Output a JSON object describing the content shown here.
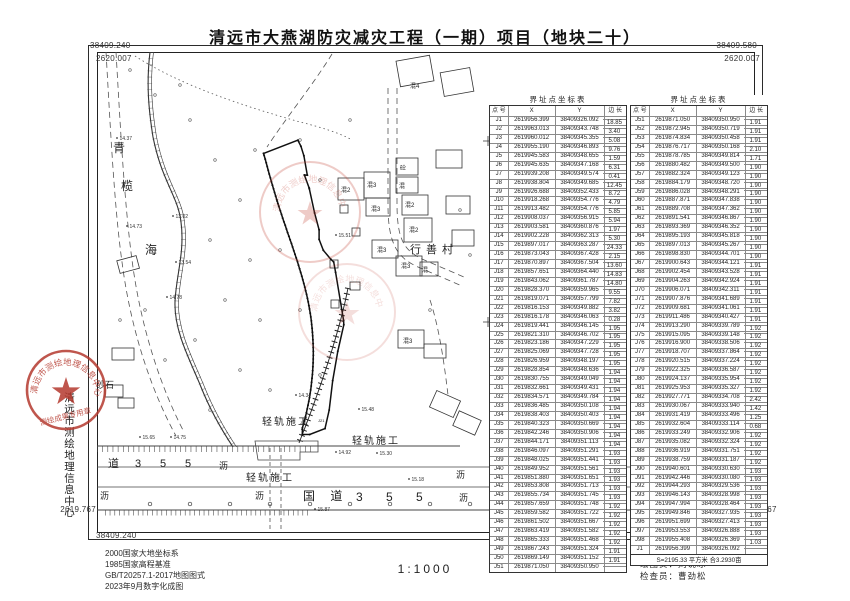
{
  "title": "清远市大燕湖防灾减灾工程（一期）项目（地块二十）",
  "frame": {
    "top_left_x": "38409.240",
    "top_left_y": "2620.007",
    "top_right_x": "38409.580",
    "top_right_y": "2620.007",
    "bottom_left_y": "2619.767",
    "bottom_left_x": "38409.240",
    "bottom_right_y": "2619.767",
    "bottom_right_x": "38409.580"
  },
  "tables": [
    {
      "title": "界址点坐标表",
      "headers": [
        "点 号",
        "X",
        "Y",
        "边 长"
      ],
      "rows": [
        [
          "J1",
          "2619956.399",
          "38409326.092"
        ],
        [
          "J2",
          "2619963.013",
          "38409343.748"
        ],
        [
          "J3",
          "2619960.012",
          "38409345.355"
        ],
        [
          "J4",
          "2619955.190",
          "38409346.893"
        ],
        [
          "J5",
          "2619945.583",
          "38409348.655"
        ],
        [
          "J6",
          "2619945.635",
          "38409347.168"
        ],
        [
          "J7",
          "2619939.208",
          "38409349.574"
        ],
        [
          "J8",
          "2619938.804",
          "38409349.685"
        ],
        [
          "J9",
          "2619926.688",
          "38409352.433"
        ],
        [
          "J10",
          "2619918.268",
          "38409354.776"
        ],
        [
          "J11",
          "2619913.482",
          "38409354.776"
        ],
        [
          "J12",
          "2619908.037",
          "38409356.915"
        ],
        [
          "J13",
          "2619903.581",
          "38409360.876"
        ],
        [
          "J14",
          "2619902.228",
          "38409362.313"
        ],
        [
          "J15",
          "2619897.017",
          "38409363.287"
        ],
        [
          "J16",
          "2619873.043",
          "38409367.428"
        ],
        [
          "J17",
          "2619870.897",
          "38409367.504"
        ],
        [
          "J18",
          "2619857.651",
          "38409364.440"
        ],
        [
          "J19",
          "2619843.062",
          "38409361.787"
        ],
        [
          "J20",
          "2619828.370",
          "38409359.965"
        ],
        [
          "J21",
          "2619819.071",
          "38409357.799"
        ],
        [
          "J22",
          "2619816.153",
          "38409349.882"
        ],
        [
          "J23",
          "2619816.178",
          "38409346.063"
        ],
        [
          "J24",
          "2619819.441",
          "38409346.145"
        ],
        [
          "J25",
          "2619821.310",
          "38409346.702"
        ],
        [
          "J26",
          "2619823.186",
          "38409347.229"
        ],
        [
          "J27",
          "2619825.069",
          "38409347.728"
        ],
        [
          "J28",
          "2619826.959",
          "38409348.197"
        ],
        [
          "J29",
          "2619828.854",
          "38409348.636"
        ],
        [
          "J30",
          "2619830.755",
          "38409349.049"
        ],
        [
          "J31",
          "2619832.661",
          "38409349.431"
        ],
        [
          "J32",
          "2619834.571",
          "38409349.784"
        ],
        [
          "J33",
          "2619836.485",
          "38409350.108"
        ],
        [
          "J34",
          "2619838.403",
          "38409350.403"
        ],
        [
          "J35",
          "2619840.323",
          "38409350.669"
        ],
        [
          "J36",
          "2619842.246",
          "38409350.906"
        ],
        [
          "J37",
          "2619844.171",
          "38409351.113"
        ],
        [
          "J38",
          "2619846.097",
          "38409351.291"
        ],
        [
          "J39",
          "2619848.025",
          "38409351.441"
        ],
        [
          "J40",
          "2619849.952",
          "38409351.561"
        ],
        [
          "J41",
          "2619851.880",
          "38409351.651"
        ],
        [
          "J42",
          "2619853.808",
          "38409351.713"
        ],
        [
          "J43",
          "2619855.734",
          "38409351.745"
        ],
        [
          "J44",
          "2619857.659",
          "38409351.748"
        ],
        [
          "J45",
          "2619859.582",
          "38409351.722"
        ],
        [
          "J46",
          "2619861.502",
          "38409351.667"
        ],
        [
          "J47",
          "2619863.419",
          "38409351.582"
        ],
        [
          "J48",
          "2619865.333",
          "38409351.468"
        ],
        [
          "J49",
          "2619867.243",
          "38409351.324"
        ],
        [
          "J50",
          "2619869.149",
          "38409351.152"
        ],
        [
          "J51",
          "2619871.050",
          "38409350.950"
        ]
      ],
      "edge_lengths": [
        "18.85",
        "3.40",
        "5.08",
        "9.76",
        "1.59",
        "6.31",
        "0.41",
        "12.45",
        "8.72",
        "4.79",
        "5.85",
        "5.94",
        "1.97",
        "5.30",
        "24.33",
        "2.15",
        "13.60",
        "14.83",
        "14.80",
        "9.55",
        "7.82",
        "3.82",
        "0.28",
        "1.95",
        "1.95",
        "1.95",
        "1.95",
        "1.95",
        "1.94",
        "1.94",
        "1.94",
        "1.94",
        "1.94",
        "1.94",
        "1.94",
        "1.94",
        "1.94",
        "1.93",
        "1.93",
        "1.93",
        "1.93",
        "1.93",
        "1.93",
        "1.92",
        "1.92",
        "1.92",
        "1.92",
        "1.92",
        "1.91",
        "1.91"
      ]
    },
    {
      "title": "界址点坐标表",
      "headers": [
        "点 号",
        "X",
        "Y",
        "边 长"
      ],
      "rows": [
        [
          "J51",
          "2619871.050",
          "38409350.950"
        ],
        [
          "J52",
          "2619872.945",
          "38409350.719"
        ],
        [
          "J53",
          "2619874.834",
          "38409350.458"
        ],
        [
          "J54",
          "2619876.717",
          "38409350.168"
        ],
        [
          "J55",
          "2619878.785",
          "38409349.814"
        ],
        [
          "J56",
          "2619880.482",
          "38409349.500"
        ],
        [
          "J57",
          "2619882.324",
          "38409349.123"
        ],
        [
          "J58",
          "2619884.179",
          "38409348.720"
        ],
        [
          "J59",
          "2619886.028",
          "38409348.291"
        ],
        [
          "J60",
          "2619887.871",
          "38409347.838"
        ],
        [
          "J61",
          "2619889.708",
          "38409347.362"
        ],
        [
          "J62",
          "2619891.541",
          "38409346.867"
        ],
        [
          "J63",
          "2619893.369",
          "38409346.352"
        ],
        [
          "J64",
          "2619895.193",
          "38409345.818"
        ],
        [
          "J65",
          "2619897.013",
          "38409345.267"
        ],
        [
          "J66",
          "2619898.830",
          "38409344.701"
        ],
        [
          "J67",
          "2619900.643",
          "38409344.121"
        ],
        [
          "J68",
          "2619902.454",
          "38409343.528"
        ],
        [
          "J69",
          "2619904.263",
          "38409342.924"
        ],
        [
          "J70",
          "2619906.071",
          "38409342.311"
        ],
        [
          "J71",
          "2619907.876",
          "38409341.689"
        ],
        [
          "J72",
          "2619909.681",
          "38409341.061"
        ],
        [
          "J73",
          "2619911.486",
          "38409340.427"
        ],
        [
          "J74",
          "2619913.290",
          "38409339.789"
        ],
        [
          "J75",
          "2619915.095",
          "38409339.148"
        ],
        [
          "J76",
          "2619916.900",
          "38409338.506"
        ],
        [
          "J77",
          "2619918.707",
          "38409337.864"
        ],
        [
          "J78",
          "2619920.515",
          "38409337.224"
        ],
        [
          "J79",
          "2619922.325",
          "38409336.587"
        ],
        [
          "J80",
          "2619924.137",
          "38409335.954"
        ],
        [
          "J81",
          "2619925.953",
          "38409335.327"
        ],
        [
          "J82",
          "2619927.771",
          "38409334.708"
        ],
        [
          "J83",
          "2619930.067",
          "38409333.940"
        ],
        [
          "J84",
          "2619931.419",
          "38409333.496"
        ],
        [
          "J85",
          "2619932.604",
          "38409333.114"
        ],
        [
          "J86",
          "2619933.249",
          "38409332.906"
        ],
        [
          "J87",
          "2619935.082",
          "38409332.324"
        ],
        [
          "J88",
          "2619936.919",
          "38409331.751"
        ],
        [
          "J89",
          "2619938.759",
          "38409331.187"
        ],
        [
          "J90",
          "2619940.601",
          "38409330.630"
        ],
        [
          "J91",
          "2619942.446",
          "38409330.080"
        ],
        [
          "J92",
          "2619944.293",
          "38409329.536"
        ],
        [
          "J93",
          "2619946.143",
          "38409328.998"
        ],
        [
          "J94",
          "2619947.994",
          "38409328.464"
        ],
        [
          "J95",
          "2619949.846",
          "38409327.935"
        ],
        [
          "J96",
          "2619951.699",
          "38409327.413"
        ],
        [
          "J97",
          "2619953.553",
          "38409326.888"
        ],
        [
          "J98",
          "2619955.408",
          "38409326.369"
        ],
        [
          "J1",
          "2619956.399",
          "38409326.092"
        ]
      ],
      "edge_lengths": [
        "1.91",
        "1.91",
        "1.91",
        "2.10",
        "1.71",
        "1.90",
        "1.90",
        "1.90",
        "1.90",
        "1.90",
        "1.90",
        "1.90",
        "1.90",
        "1.90",
        "1.90",
        "1.90",
        "1.91",
        "1.91",
        "1.91",
        "1.91",
        "1.91",
        "1.91",
        "1.91",
        "1.92",
        "1.92",
        "1.92",
        "1.92",
        "1.92",
        "1.92",
        "1.92",
        "1.92",
        "2.42",
        "1.42",
        "1.25",
        "0.68",
        "1.92",
        "1.92",
        "1.92",
        "1.92",
        "1.93",
        "1.93",
        "1.93",
        "1.93",
        "1.93",
        "1.93",
        "1.93",
        "1.93",
        "1.03"
      ],
      "footer": "S=2195.33  平方米  合3.2930亩"
    }
  ],
  "map": {
    "labels": [
      {
        "t": "青",
        "x": 113,
        "y": 152,
        "s": 12
      },
      {
        "t": "榄",
        "x": 121,
        "y": 190,
        "s": 12
      },
      {
        "t": "海",
        "x": 145,
        "y": 254,
        "s": 12
      },
      {
        "t": "砂石",
        "x": 38,
        "y": 308,
        "s": 9
      },
      {
        "t": "砂石",
        "x": 96,
        "y": 388,
        "s": 9
      },
      {
        "t": "轻轨施工",
        "x": 262,
        "y": 425,
        "s": 10,
        "ls": 2
      },
      {
        "t": "轻轨施工",
        "x": 352,
        "y": 444,
        "s": 10,
        "ls": 2
      },
      {
        "t": "轻轨施工",
        "x": 246,
        "y": 481,
        "s": 10,
        "ls": 2
      },
      {
        "t": "行善村",
        "x": 410,
        "y": 253,
        "s": 11,
        "ls": 5
      },
      {
        "t": "混2",
        "x": 341,
        "y": 192,
        "s": 6
      },
      {
        "t": "混3",
        "x": 367,
        "y": 187,
        "s": 6
      },
      {
        "t": "砼",
        "x": 400,
        "y": 170,
        "s": 6
      },
      {
        "t": "混",
        "x": 399,
        "y": 188,
        "s": 6
      },
      {
        "t": "混2",
        "x": 405,
        "y": 207,
        "s": 6
      },
      {
        "t": "混3",
        "x": 371,
        "y": 211,
        "s": 6
      },
      {
        "t": "混2",
        "x": 409,
        "y": 232,
        "s": 6
      },
      {
        "t": "混3",
        "x": 377,
        "y": 252,
        "s": 6
      },
      {
        "t": "混3",
        "x": 401,
        "y": 268,
        "s": 6
      },
      {
        "t": "混",
        "x": 422,
        "y": 272,
        "s": 6
      },
      {
        "t": "混4",
        "x": 410,
        "y": 88,
        "s": 6
      },
      {
        "t": "混3",
        "x": 403,
        "y": 343,
        "s": 6
      },
      {
        "t": "国  道",
        "x": 303,
        "y": 500,
        "s": 12,
        "ls": 6
      },
      {
        "t": "3  5  5",
        "x": 356,
        "y": 501,
        "s": 12,
        "ls": 10
      },
      {
        "t": "道",
        "x": 108,
        "y": 467,
        "s": 11
      },
      {
        "t": "3",
        "x": 135,
        "y": 467,
        "s": 11
      },
      {
        "t": "5",
        "x": 160,
        "y": 467,
        "s": 11
      },
      {
        "t": "5",
        "x": 185,
        "y": 467,
        "s": 11
      },
      {
        "t": "沥",
        "x": 219,
        "y": 469,
        "s": 9
      },
      {
        "t": "沥",
        "x": 100,
        "y": 499,
        "s": 9
      },
      {
        "t": "沥",
        "x": 255,
        "y": 499,
        "s": 9
      },
      {
        "t": "沥",
        "x": 456,
        "y": 478,
        "s": 9
      },
      {
        "t": "沥",
        "x": 459,
        "y": 501,
        "s": 9
      },
      {
        "t": "J22",
        "x": 300,
        "y": 424,
        "s": 4
      },
      {
        "t": "J21",
        "x": 318,
        "y": 422,
        "s": 4
      }
    ],
    "spot_elevations": [
      {
        "x": 117,
        "y": 138,
        "v": "14.37"
      },
      {
        "x": 127,
        "y": 226,
        "v": "14.73"
      },
      {
        "x": 173,
        "y": 216,
        "v": "13.02"
      },
      {
        "x": 176,
        "y": 262,
        "v": "13.54"
      },
      {
        "x": 167,
        "y": 297,
        "v": "14.78"
      },
      {
        "x": 140,
        "y": 437,
        "v": "15.65"
      },
      {
        "x": 171,
        "y": 437,
        "v": "14.75"
      },
      {
        "x": 336,
        "y": 235,
        "v": "15.51"
      },
      {
        "x": 296,
        "y": 395,
        "v": "14.34"
      },
      {
        "x": 336,
        "y": 452,
        "v": "14.92"
      },
      {
        "x": 359,
        "y": 409,
        "v": "15.48"
      },
      {
        "x": 377,
        "y": 453,
        "v": "15.30"
      },
      {
        "x": 409,
        "y": 479,
        "v": "15.18"
      },
      {
        "x": 315,
        "y": 509,
        "v": "15.87"
      }
    ]
  },
  "stamps": {
    "ring_text": "清远市测绘地理信息中心",
    "banner_text": "测绘成果专用章"
  },
  "footer": {
    "notes": [
      "2000国家大地坐标系",
      "1985国家高程基准",
      "GB/T20257.1-2017地图图式",
      "2023年9月数字化成图"
    ],
    "scale": "1:1000",
    "credits": [
      "测量员：孔  明",
      "绘图员：刘说冰",
      "检查员：曹劲松"
    ]
  }
}
